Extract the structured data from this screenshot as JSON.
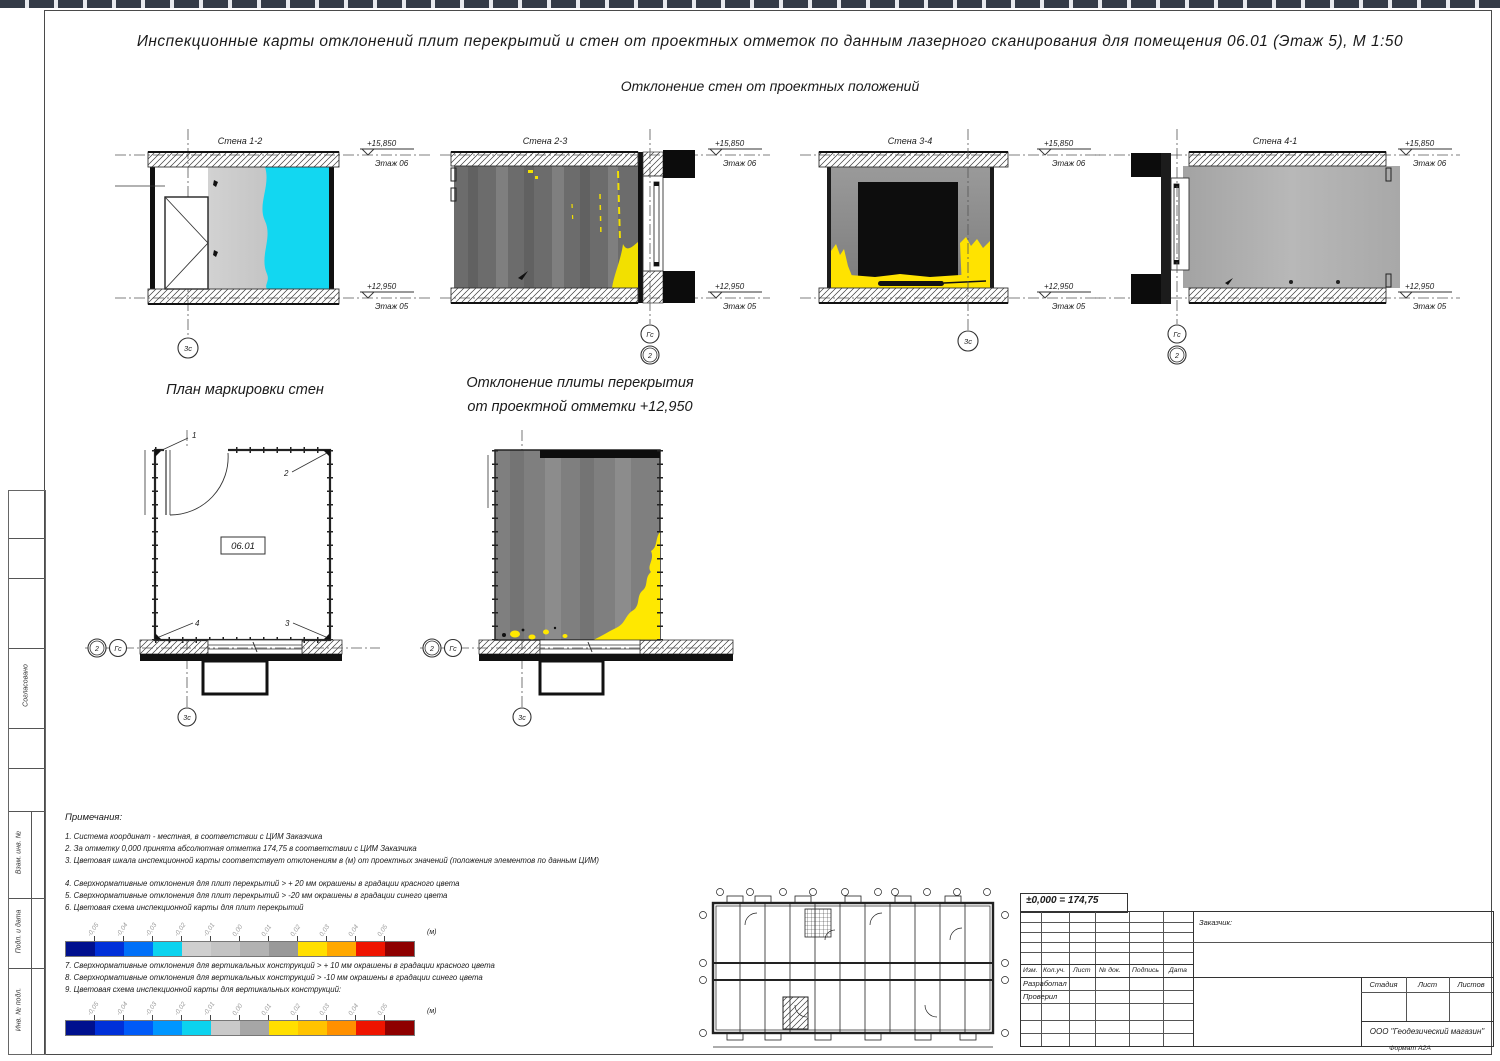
{
  "header": {
    "title": "Инспекционные карты отклонений плит перекрытий и стен от проектных отметок по данным лазерного сканирования для помещения 06.01 (Этаж 5), М 1:50",
    "subtitle": "Отклонение стен от проектных положений"
  },
  "frame": {
    "side_labels": [
      "Согласовано",
      "Взам. инв. №",
      "Подп. и дата",
      "Инв. № подл."
    ]
  },
  "walls": [
    {
      "label": "Стена 1-2",
      "elev_top": "+15,850",
      "floor_top": "Этаж 06",
      "elev_bot": "+12,950",
      "floor_bot": "Этаж 05",
      "axis1": "3с",
      "axis2": ""
    },
    {
      "label": "Стена 2-3",
      "elev_top": "+15,850",
      "floor_top": "Этаж 06",
      "elev_bot": "+12,950",
      "floor_bot": "Этаж 05",
      "axis1": "Гс",
      "axis2": "2"
    },
    {
      "label": "Стена 3-4",
      "elev_top": "+15,850",
      "floor_top": "Этаж 06",
      "elev_bot": "+12,950",
      "floor_bot": "Этаж 05",
      "axis1": "3с",
      "axis2": ""
    },
    {
      "label": "Стена 4-1",
      "elev_top": "+15,850",
      "floor_top": "Этаж 06",
      "elev_bot": "+12,950",
      "floor_bot": "Этаж 05",
      "axis1": "Гс",
      "axis2": "2"
    }
  ],
  "marking_plan": {
    "title": "План маркировки стен",
    "room": "06.01",
    "corners": [
      "1",
      "2",
      "3",
      "4"
    ],
    "axis_h1": "2",
    "axis_h2": "Гс",
    "axis_v": "3с"
  },
  "slab_map": {
    "title_line1": "Отклонение плиты перекрытия",
    "title_line2": "от проектной отметки +12,950",
    "axis_h1": "2",
    "axis_h2": "Гс",
    "axis_v": "3с"
  },
  "notes": {
    "heading": "Примечания:",
    "group1": [
      "1. Система координат - местная, в соответствии с ЦИМ Заказчика",
      "2. За отметку 0,000 принята абсолютная отметка 174,75 в соответствии с ЦИМ Заказчика",
      "3. Цветовая шкала инспекционной карты соответствует отклонениям в (м) от проектных значений (положения элементов по данным ЦИМ)"
    ],
    "group2": [
      "4. Сверхнормативные отклонения для плит перекрытий > + 20 мм окрашены в градации красного цвета",
      "5. Сверхнормативные отклонения для плит перекрытий > -20 мм окрашены в градации синего цвета",
      "6. Цветовая схема инспекционной карты для плит перекрытий"
    ],
    "group3": [
      "7. Сверхнормативные отклонения для  вертикальных конструкций > + 10 мм окрашены в градации красного цвета",
      "8. Сверхнормативные отклонения для вертикальных конструкций > -10 мм окрашены в градации синего цвета",
      "9. Цветовая схема инспекционной карты для вертикальных конструкций:"
    ]
  },
  "scales": {
    "slab": {
      "unit": "(м)",
      "colors": [
        "#00108e",
        "#0030d9",
        "#0070f8",
        "#0cd3ef",
        "#cfcfcf",
        "#c3c3c3",
        "#b2b2b2",
        "#999999",
        "#ffdf00",
        "#ffa800",
        "#ef1400",
        "#8e0000"
      ],
      "tick_labels": [
        "-0,05",
        "-0,04",
        "-0,03",
        "-0,02",
        "-0,01",
        "0,00",
        "0,01",
        "0,02",
        "0,03",
        "0,04",
        "0,05"
      ]
    },
    "vertical": {
      "unit": "(м)",
      "colors": [
        "#00108e",
        "#0030d9",
        "#005af8",
        "#0096ff",
        "#0cd3ef",
        "#c9c9c9",
        "#a6a6a6",
        "#ffdf00",
        "#ffc300",
        "#ff9000",
        "#ef1400",
        "#8e0000"
      ],
      "tick_labels": [
        "-0,05",
        "-0,04",
        "-0,03",
        "-0,02",
        "-0,01",
        "0,00",
        "0,01",
        "0,02",
        "0,03",
        "0,04",
        "0,05"
      ]
    }
  },
  "titleblock": {
    "datum": "±0,000  =  174,75",
    "customer": "Заказчик:",
    "cols": [
      "Изм.",
      "Кол.уч.",
      "Лист",
      "№ док.",
      "Подпись",
      "Дата"
    ],
    "row1": "Разработал",
    "row2": "Проверил",
    "stage_cols": [
      "Стадия",
      "Лист",
      "Листов"
    ],
    "company": "ООО \"Геодезический магазин\"",
    "format": "Формат  А2А"
  }
}
